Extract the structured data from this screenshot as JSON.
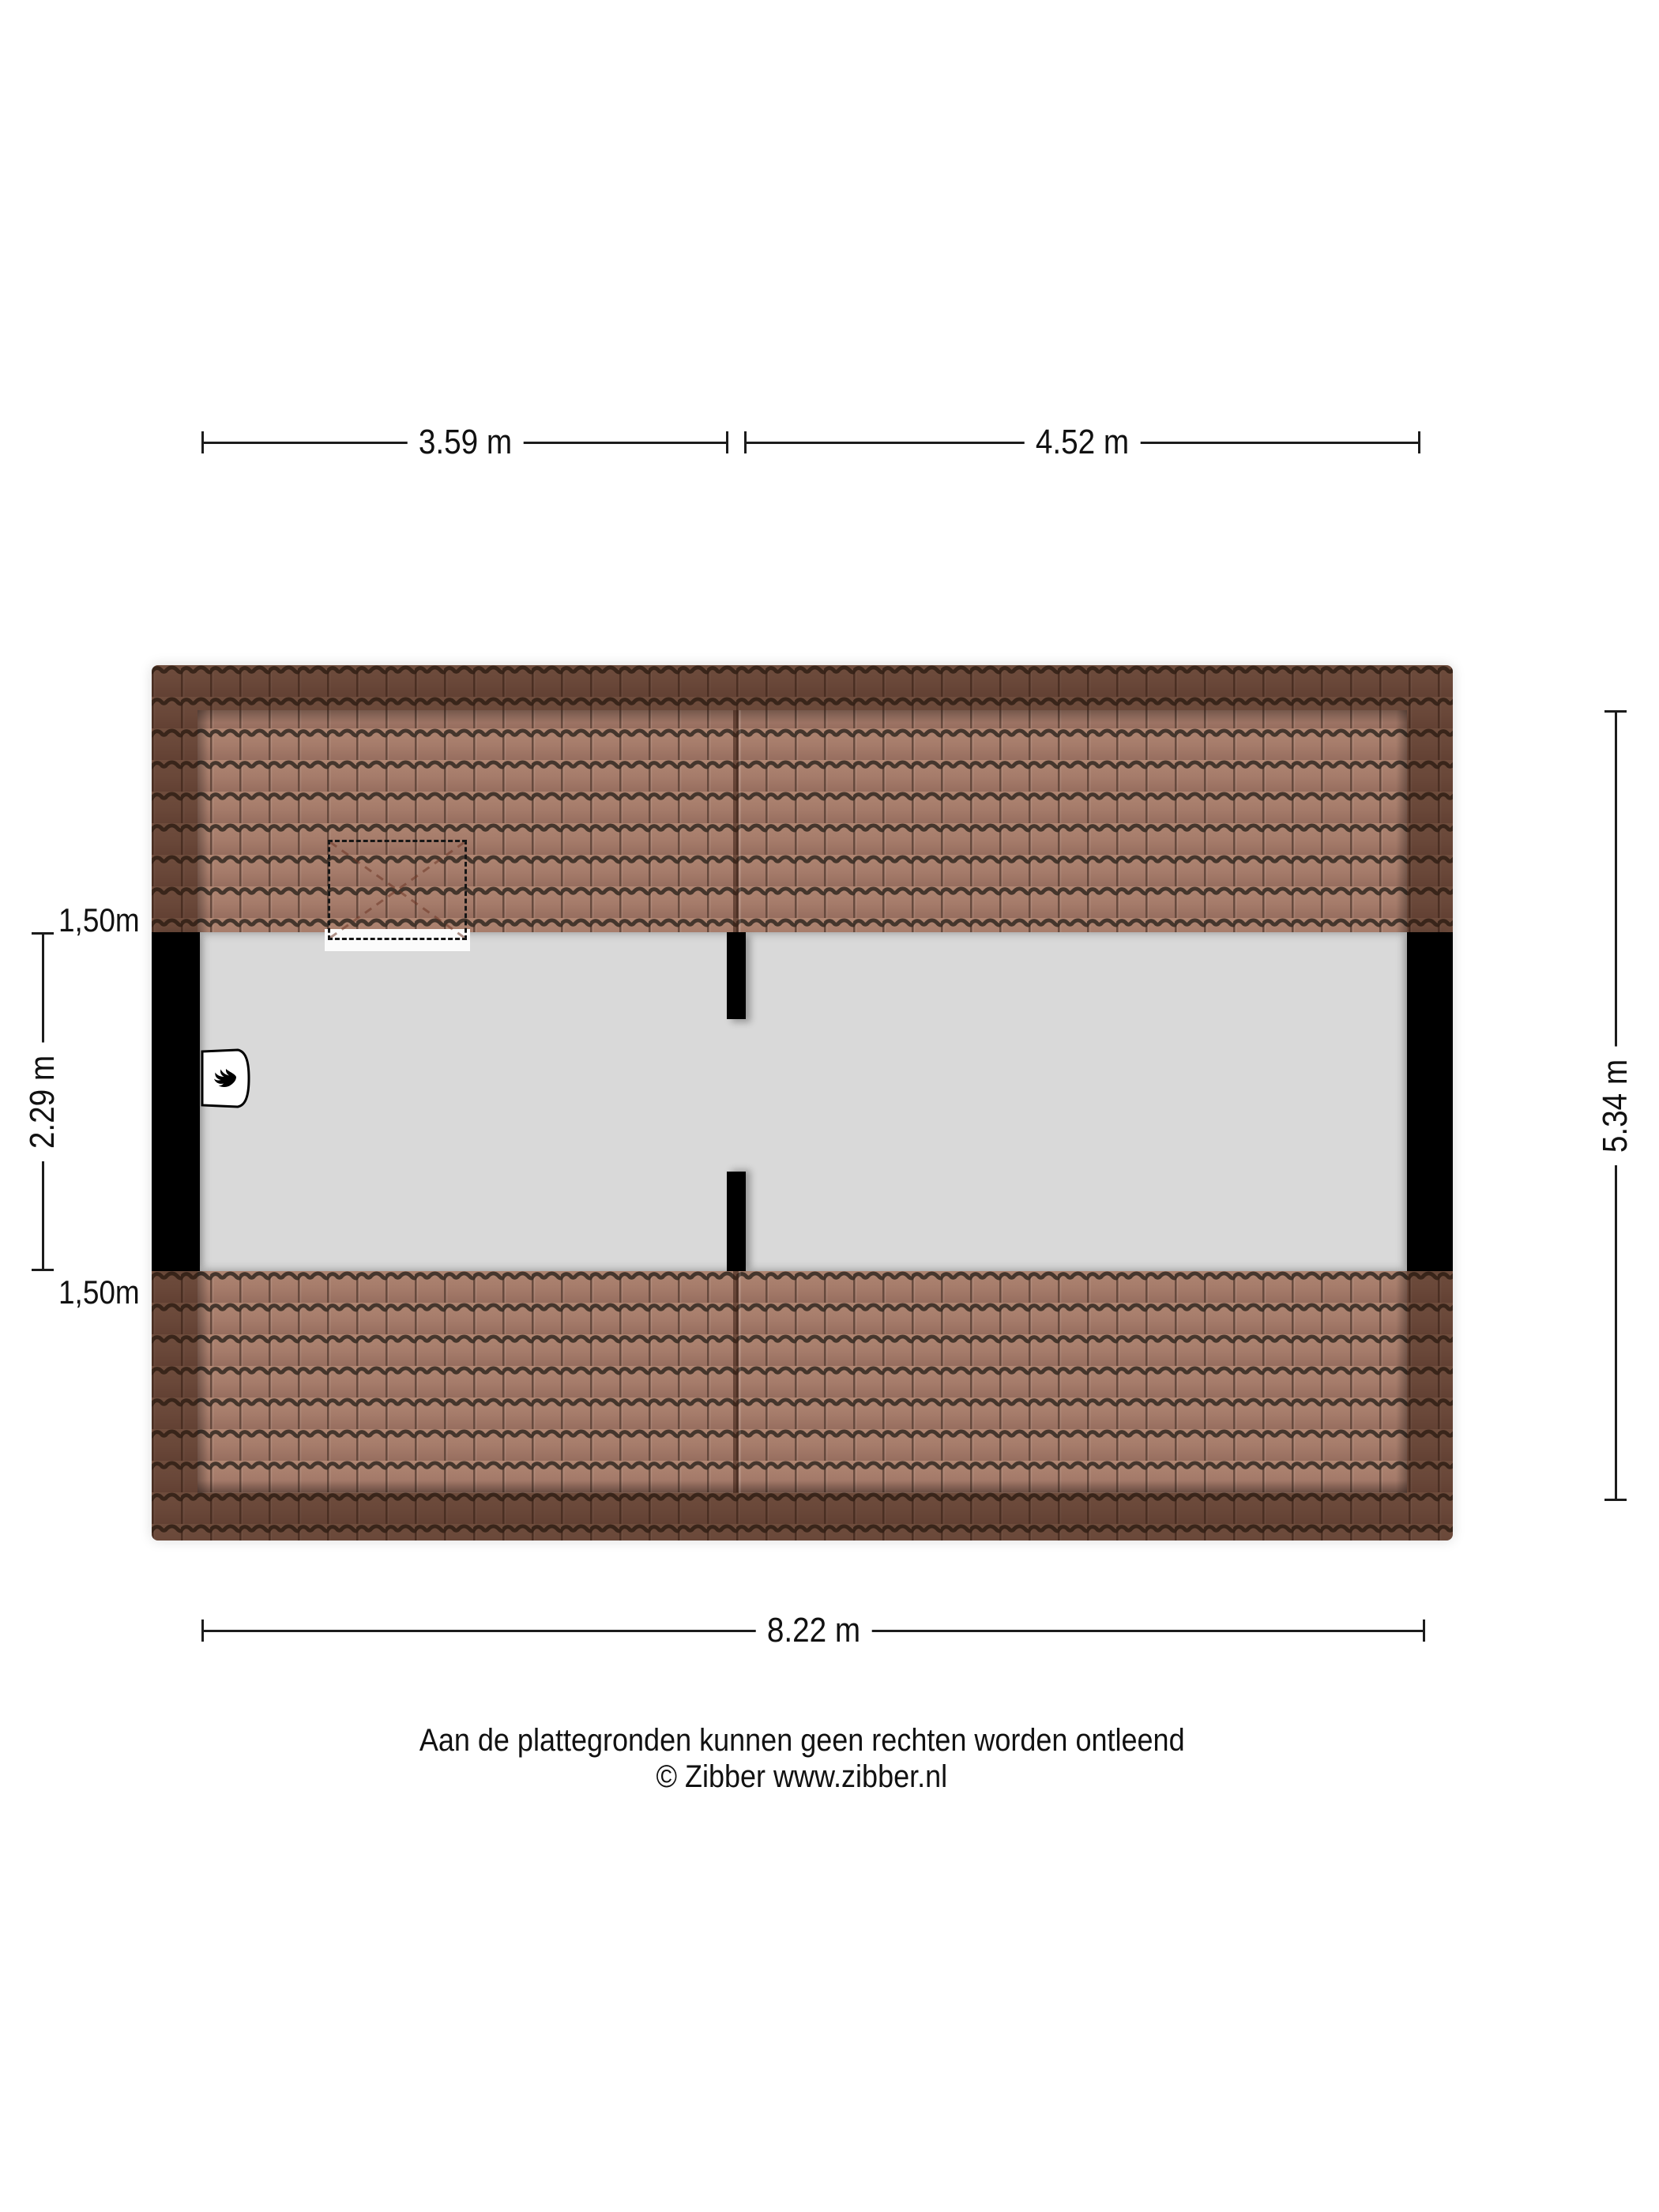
{
  "plan": {
    "room_label": "Zolder",
    "colors": {
      "floor": "#d9d9d9",
      "wall": "#000000",
      "tile_face_light": "#a87e6e",
      "tile_face_dark": "#6f4a3b",
      "tile_groove": "#362b23",
      "dimension_line": "#1c1c1c"
    },
    "icons": {
      "boiler": "flame-icon",
      "roof_window": "dashed-roof-window"
    }
  },
  "dimensions": {
    "top_segment_1": "3.59 m",
    "top_segment_2": "4.52 m",
    "bottom_total": "8.22 m",
    "right_total": "5.34 m",
    "left_room": "2.29 m",
    "left_roof_top": "1,50m",
    "left_roof_bottom": "1,50m"
  },
  "footer": {
    "disclaimer": "Aan de plattegronden kunnen geen rechten worden ontleend",
    "copyright": "© Zibber www.zibber.nl"
  }
}
